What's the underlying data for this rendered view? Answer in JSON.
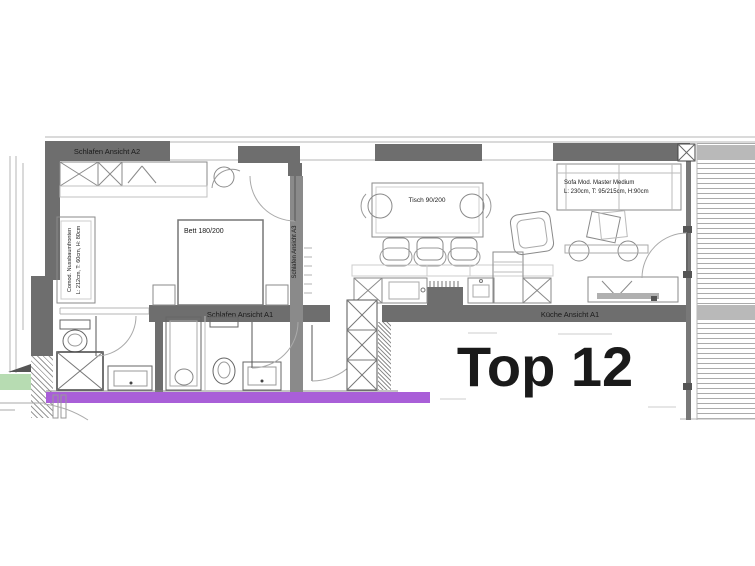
{
  "unit": {
    "name": "Top 12"
  },
  "labels": {
    "wall_a2": "Schlafen Ansicht A2",
    "wall_a1": "Schlafen Ansicht A1",
    "wall_a3_vertical": "Schlafen Ansicht A3",
    "wall_kueche": "Küche Ansicht A1",
    "bed": "Bett 180/200",
    "dining_table": "Tisch 90/200",
    "sofa_line1": "Sofa Mod. Master Medium",
    "sofa_line2": "L: 230cm, T: 95/215cm, H:90cm",
    "sideboard_line1": "Comod. Nussbaumfronten",
    "sideboard_line2": "L: 212cm, T: 60cm, H: 80cm"
  },
  "colors": {
    "wall": "#6e6e6e",
    "wall_light": "#b9b9b9",
    "divider_wall": "#8a8a8a",
    "accent_purple": "#a95fd8",
    "accent_green": "#b7dcb2",
    "text": "#1a1a1a"
  }
}
